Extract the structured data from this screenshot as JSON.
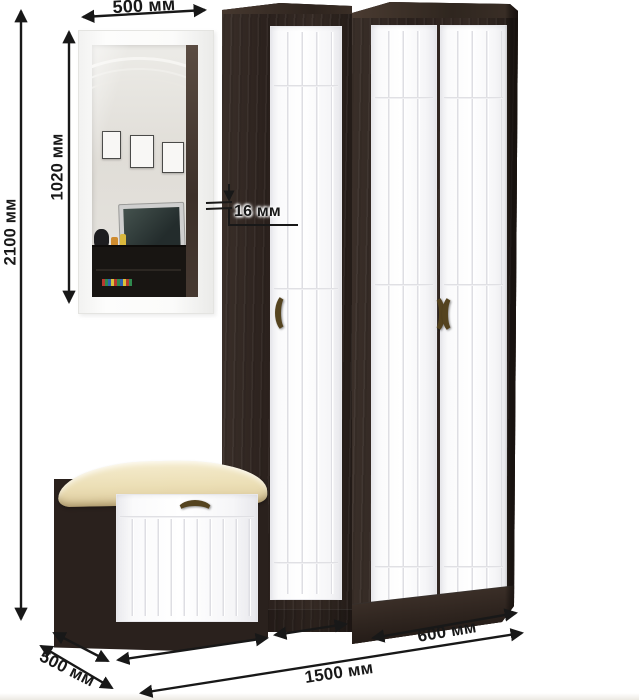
{
  "diagram": {
    "kind": "furniture-dimension-diagram",
    "unit": "мм"
  },
  "annotations": {
    "mirror_width": "500 мм",
    "mirror_height": "1020 мм",
    "total_height": "2100 мм",
    "panel_thickness": "16 мм",
    "right_section_width": "600 мм",
    "total_width": "1500 мм",
    "depth": "500 мм"
  },
  "values": {
    "mirror_width": 500,
    "mirror_height": 1020,
    "total_height": 2100,
    "panel_thickness": 16,
    "right_section_width": 600,
    "total_width": 1500,
    "depth": 500
  },
  "colors": {
    "background": "#ffffff",
    "wenge_dark": "#2a211d",
    "wenge_light": "#3a2f29",
    "door_white": "#fbfbfc",
    "groove_gray": "#dedee3",
    "cushion_cream": "#ecdfb6",
    "handle_bronze": "#54431f",
    "dimension_ink": "#181818"
  }
}
